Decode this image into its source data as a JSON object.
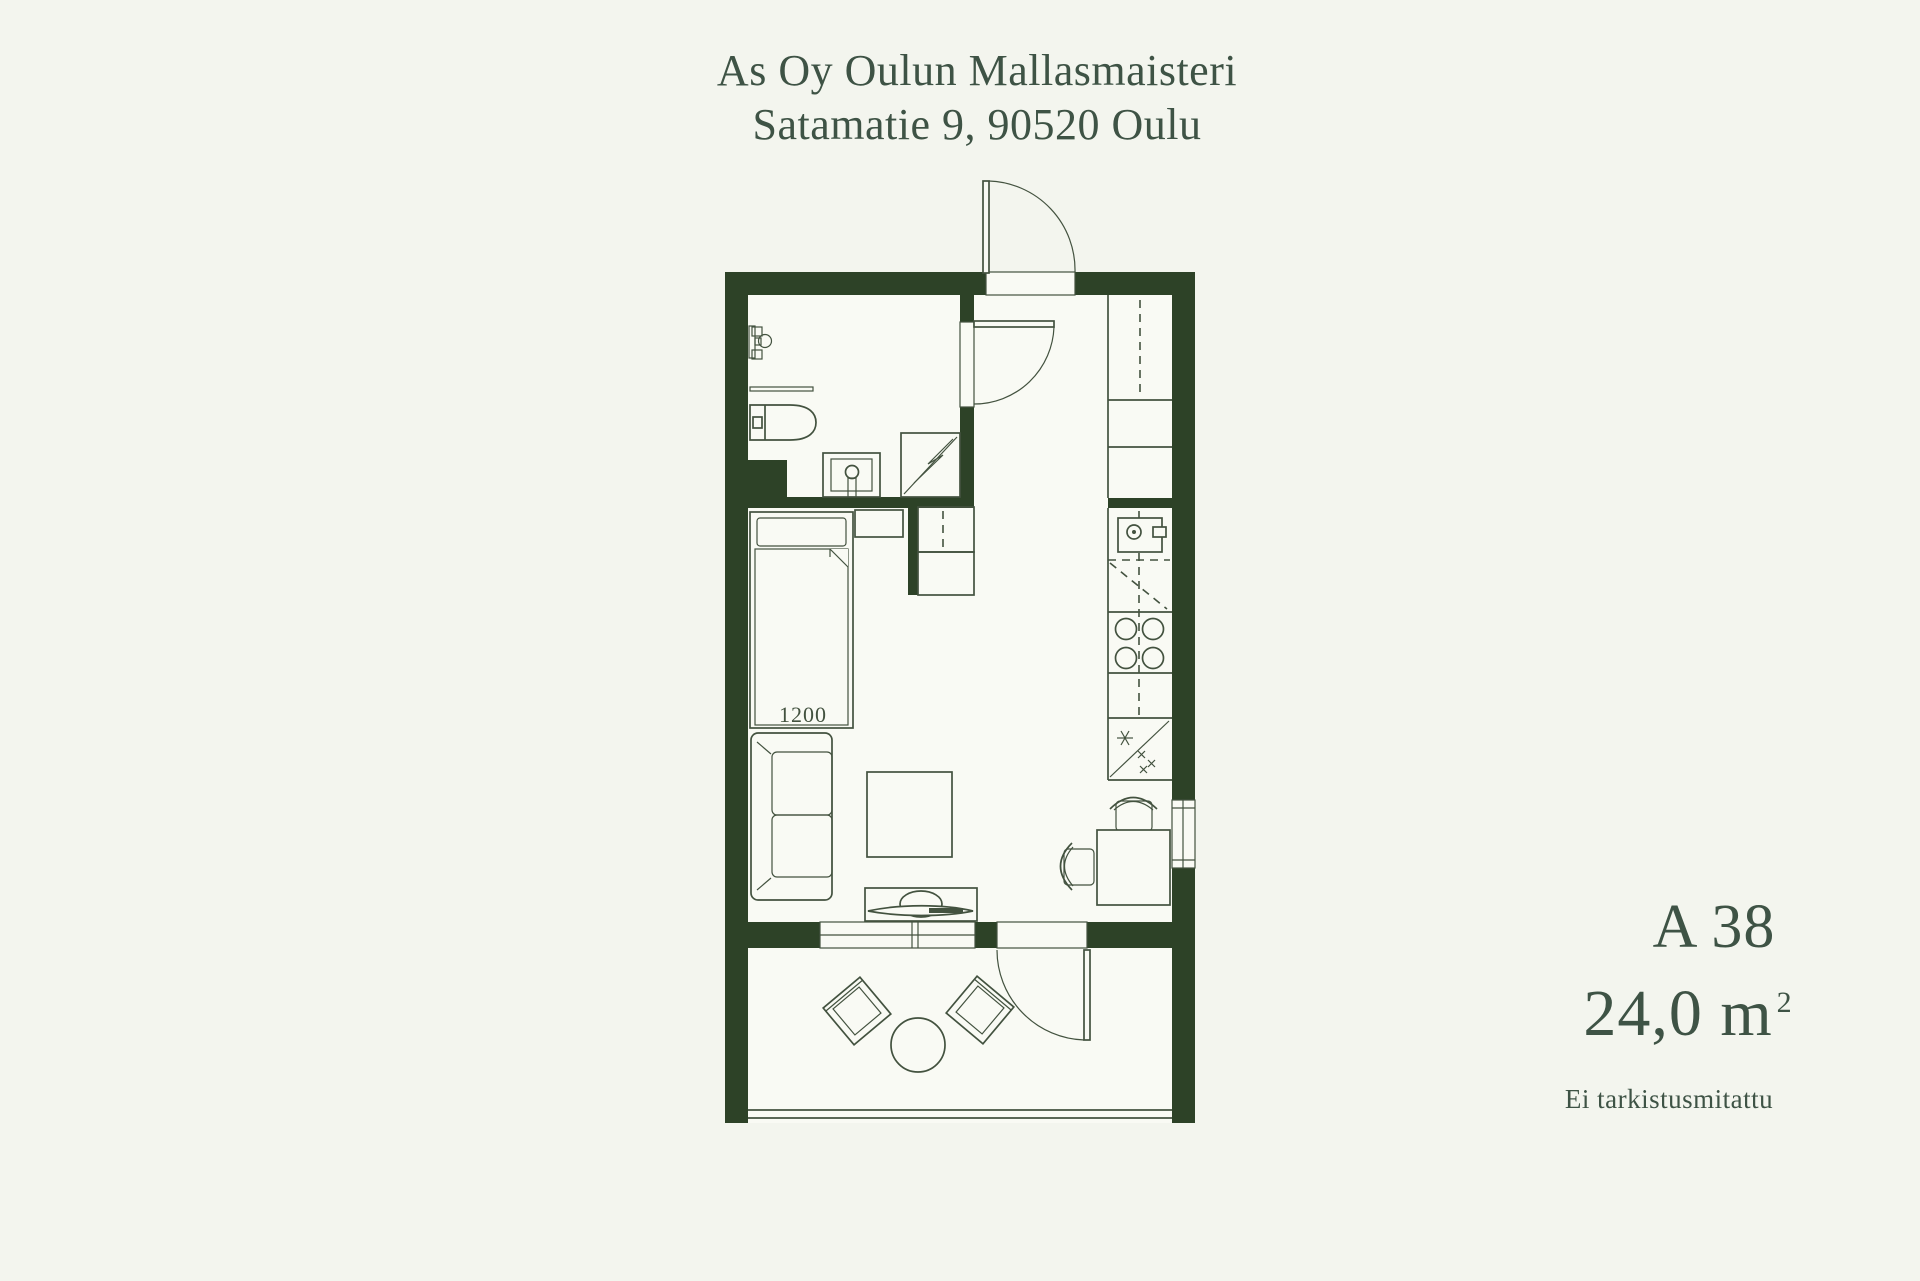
{
  "header": {
    "line1": "As Oy Oulun Mallasmaisteri",
    "line2": "Satamatie 9, 90520 Oulu"
  },
  "unit_info": {
    "unit_id": "A 38",
    "area_value": "24,0 m",
    "area_superscript": "2",
    "note": "Ei tarkistusmitattu"
  },
  "floorplan": {
    "bed_dimension": "1200",
    "fixtures": [
      "entrance-door",
      "bathroom-door",
      "balcony-door",
      "toilet",
      "sink",
      "shower",
      "towel-rail",
      "toilet-paper-holder",
      "bed",
      "nightstand",
      "wardrobe",
      "hall-closet",
      "tall-cabinet",
      "washing-machine",
      "stove",
      "fridge-freezer",
      "counter",
      "sofa",
      "coffee-table",
      "tv-stand",
      "tv",
      "dining-table",
      "dining-chair",
      "window",
      "balcony-railing",
      "balcony-chair",
      "balcony-table"
    ]
  },
  "colors": {
    "background": "#f3f5ee",
    "floor": "#f9faf4",
    "wall": "#2d4227",
    "line": "#43523f",
    "text": "#3e5345"
  }
}
